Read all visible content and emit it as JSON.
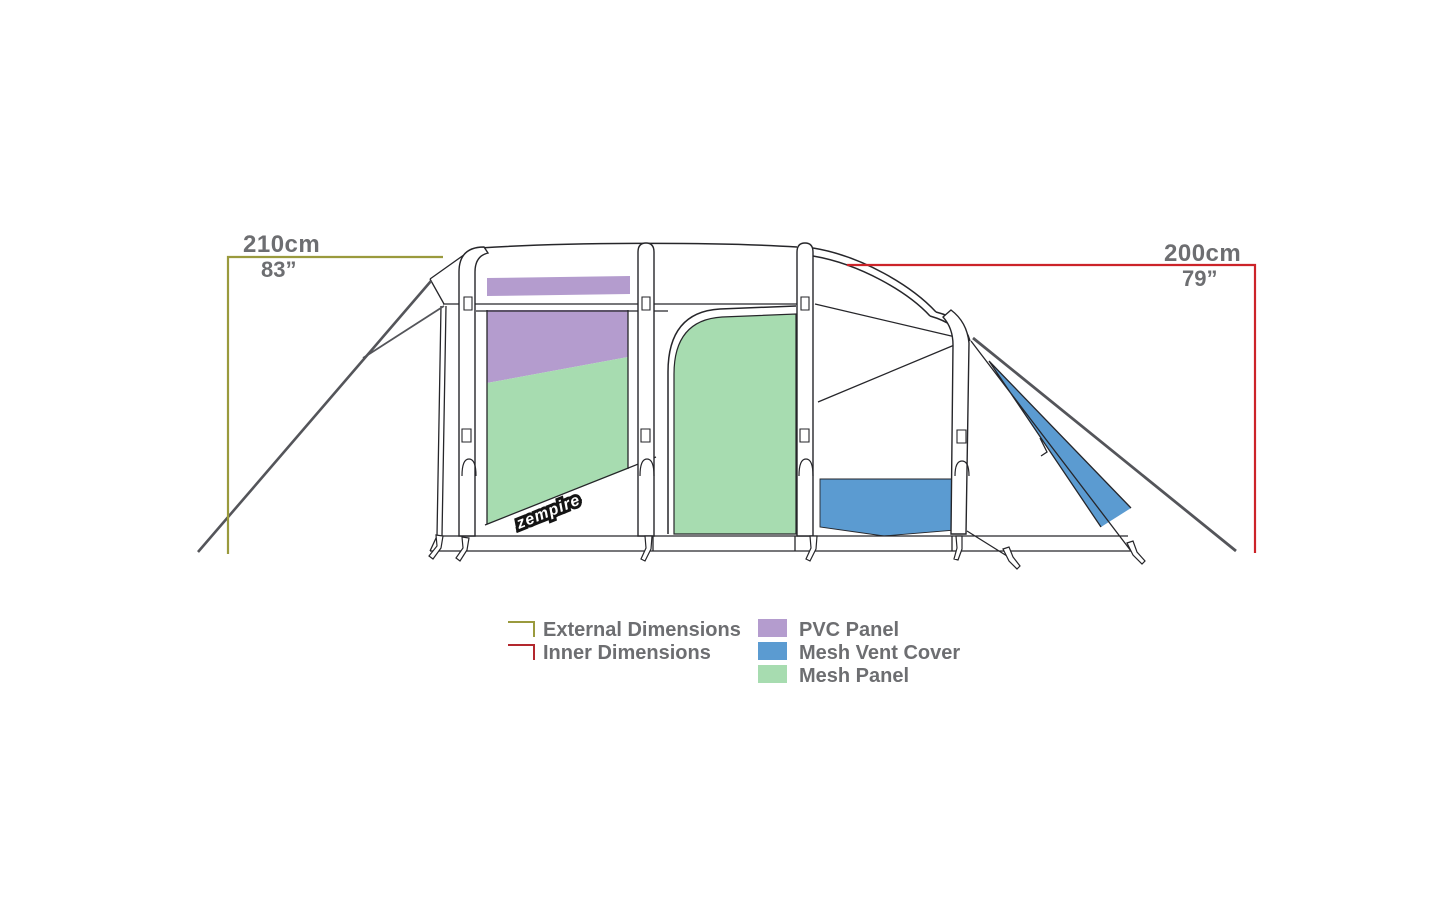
{
  "diagram": {
    "external_dimension": {
      "metric": "210cm",
      "imperial": "83”",
      "color": "#9a9a3d"
    },
    "inner_dimension": {
      "metric": "200cm",
      "imperial": "79”",
      "color": "#cc2329"
    },
    "brand_logo": "zempire"
  },
  "legend": {
    "text_color": "#6d6e71",
    "dimension_items": [
      {
        "label": "External Dimensions",
        "color": "#9a9a3d"
      },
      {
        "label": "Inner Dimensions",
        "color": "#b3282e"
      }
    ],
    "panel_items": [
      {
        "label": "PVC Panel",
        "color": "#b49cce"
      },
      {
        "label": "Mesh Vent Cover",
        "color": "#5b9bd1"
      },
      {
        "label": "Mesh Panel",
        "color": "#a7dcb0"
      }
    ]
  },
  "colors": {
    "line_art": "#26262a",
    "rope": "#54555a"
  }
}
